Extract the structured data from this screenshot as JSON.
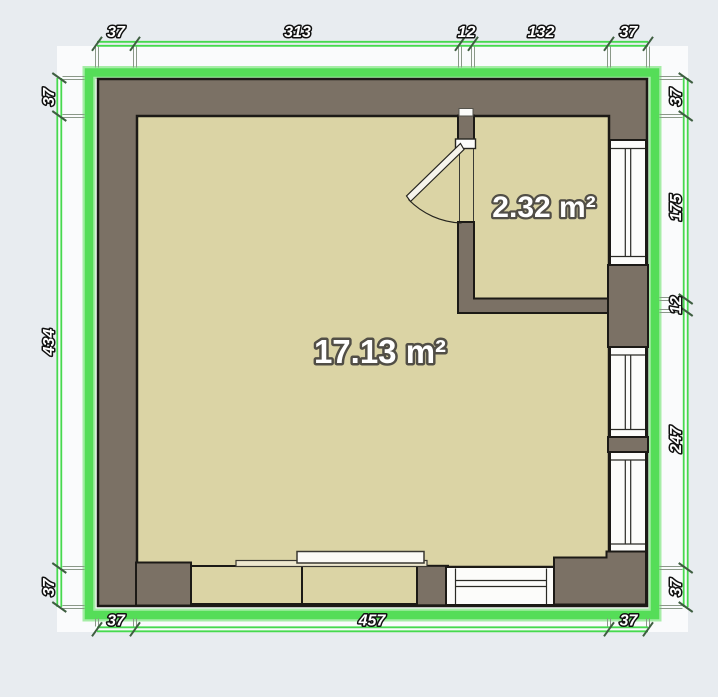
{
  "plan": {
    "rooms": [
      {
        "id": "main-room",
        "area_label": "17.13 m²"
      },
      {
        "id": "small-room",
        "area_label": "2.32 m²"
      }
    ],
    "dimensions": {
      "top": [
        "37",
        "313",
        "12",
        "132",
        "37"
      ],
      "bottom": [
        "37",
        "457",
        "37"
      ],
      "left": [
        "37",
        "434",
        "37"
      ],
      "right": [
        "37",
        "175",
        "12",
        "247",
        "37"
      ]
    }
  },
  "colors": {
    "background": "#e8ecf0",
    "inner_background": "#fafbfc",
    "wall_fill": "#7b7165",
    "wall_outline": "#1c1a16",
    "floor_fill": "#dbd4a5",
    "window_fill": "#fcfcfa",
    "selection_green": "#55dd58",
    "dimension_text_fill": "#ffffff",
    "area_text_fill": "#ffffff"
  }
}
